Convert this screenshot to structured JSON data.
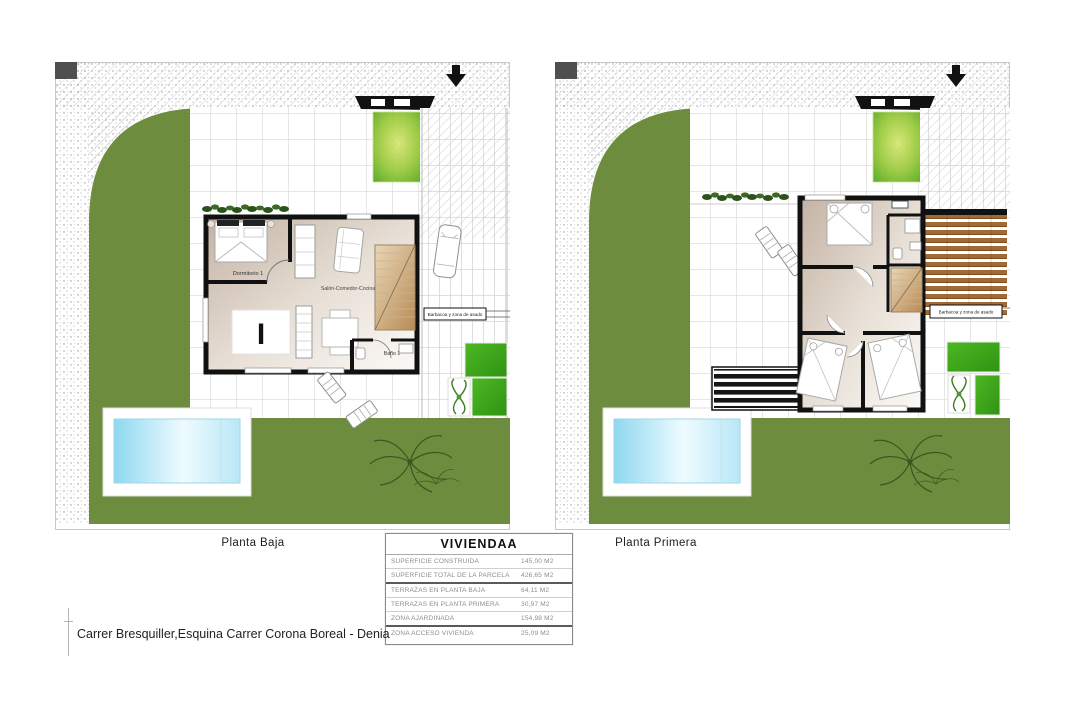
{
  "plans": {
    "left": {
      "title": "Planta Baja",
      "bedroom_label": "Dormitorio 1",
      "living_label": "Salón-Comedor-Cocina",
      "bath_label": "Baño 1",
      "rug_monogram": "I",
      "bbq_label": "Barbacoa y zona de asado"
    },
    "right": {
      "title": "Planta Primera",
      "bbq_label": "Barbacoa y zona de asado"
    }
  },
  "summary_table": {
    "title": "VIVIENDAA",
    "rows": [
      {
        "label": "SUPERFICIE CONSTRUIDA",
        "value": "145,00 M2"
      },
      {
        "label": "SUPERFICIE TOTAL DE LA PARCELA",
        "value": "426,65 M2"
      },
      {
        "label": "TERRAZAS EN PLANTA BAJA",
        "value": "64,11 M2"
      },
      {
        "label": "TERRAZAS EN PLANTA PRIMERA",
        "value": "30,97 M2"
      },
      {
        "label": "ZONA AJARDINADA",
        "value": "154,98 M2"
      },
      {
        "label": "ZONA ACCESO VIVIENDA",
        "value": "25,09 M2"
      }
    ]
  },
  "footer": {
    "address": "Carrer Bresquiller,Esquina Carrer Corona Boreal - Denia"
  },
  "colors": {
    "lawn": "#6d8c3e",
    "pool_blue": "#8ed8f0",
    "bright_grass": "#45b41e",
    "wood_deck": "#a06a34",
    "room_floor": "#c3b2a2",
    "wall": "#111111"
  }
}
